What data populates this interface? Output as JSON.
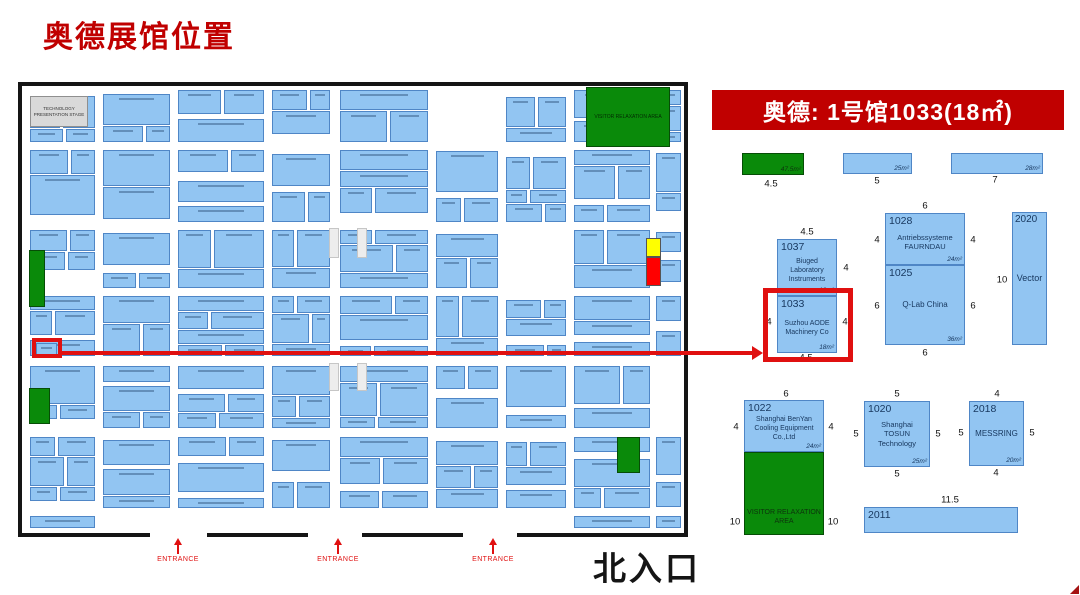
{
  "page": {
    "title": "奥德展馆位置"
  },
  "banner": {
    "text": "奥德: 1号馆1033(18㎡)"
  },
  "colors": {
    "title_red": "#c00000",
    "banner_red": "#c00000",
    "highlight_red": "#e01010",
    "booth_fill": "#92c5f2",
    "booth_border": "#4f86c6",
    "green_area": "#0a8a0a",
    "stage_gray": "#d9d9d9",
    "marker_yellow": "#ffff00",
    "marker_red": "#ff0000"
  },
  "map": {
    "stage_label": "TECHNOLOGY PRESENTATION STAGE",
    "relax_label": "VISITOR RELAXATION AREA",
    "entrances": [
      "ENTRANCE",
      "ENTRANCE",
      "ENTRANCE"
    ],
    "north_label": "北入口",
    "booth_seed": 1337
  },
  "detail": {
    "green_strip": {
      "area": "47.5m²",
      "dim_bottom": "4.5"
    },
    "strip_25": {
      "area": "25m²",
      "dim_bottom": "5"
    },
    "strip_28": {
      "area": "28m²",
      "dim_bottom": "7"
    },
    "b1037": {
      "id": "1037",
      "name": "Biuged Laboratory Instruments",
      "area": "18m²",
      "dim_top": "4.5",
      "dim_right": "4"
    },
    "b1033": {
      "id": "1033",
      "name": "Suzhou AODE Machinery Co",
      "area": "18m²",
      "dim_left": "4",
      "dim_right": "4",
      "dim_bottom": "4.5"
    },
    "b1028": {
      "id": "1028",
      "name": "Antriebssysteme FAURNDAU",
      "area": "24m²",
      "dim_top": "6",
      "dim_left": "4",
      "dim_right": "4"
    },
    "b1025": {
      "id": "1025",
      "name": "Q-Lab China",
      "area": "36m²",
      "dim_left": "6",
      "dim_right": "6",
      "dim_bottom": "6"
    },
    "b2020": {
      "id": "2020",
      "name": "Vector",
      "dim_left": "10"
    },
    "b1022": {
      "id": "1022",
      "name": "Shanghai BenYan Cooling Equipment Co.,Ltd",
      "area": "24m²",
      "dim_top": "6",
      "dim_left": "4",
      "dim_right": "4"
    },
    "visitor": {
      "name": "VISITOR RELAXATION AREA",
      "dim_left": "10",
      "dim_right": "10"
    },
    "b1020": {
      "id": "1020",
      "name": "Shanghai TOSUN Technology",
      "area": "25m²",
      "dim_top": "5",
      "dim_left": "5",
      "dim_right": "5",
      "dim_bottom": "5"
    },
    "b2018": {
      "id": "2018",
      "name": "MESSRING",
      "area": "20m²",
      "dim_top": "4",
      "dim_left": "5",
      "dim_right": "5",
      "dim_bottom": "4"
    },
    "b2011": {
      "id": "2011",
      "dim_top": "11.5"
    }
  }
}
